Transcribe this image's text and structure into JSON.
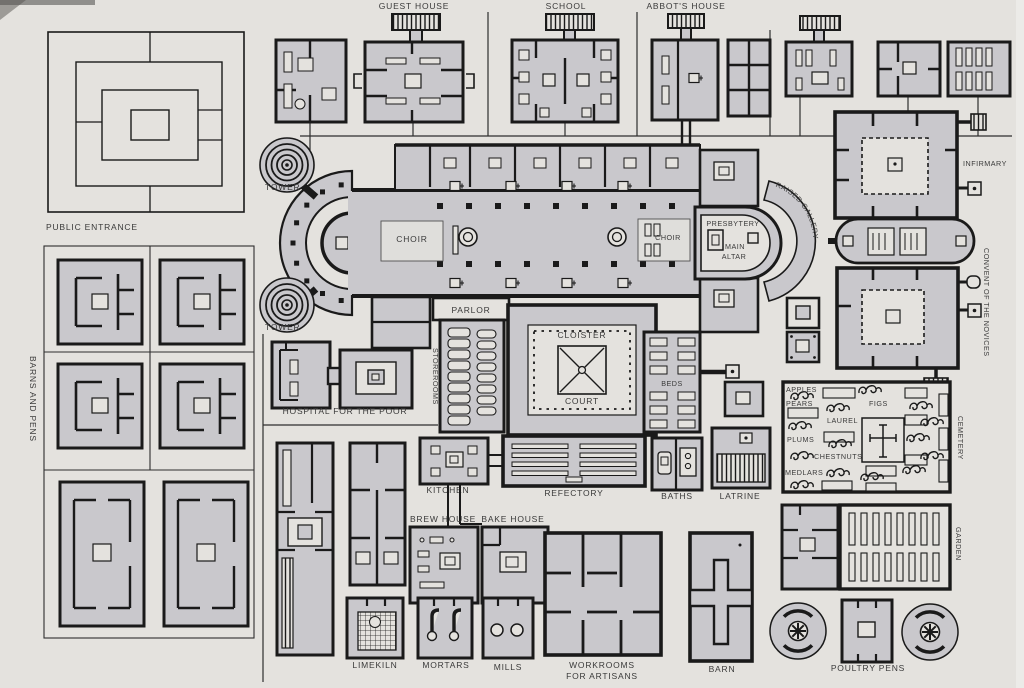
{
  "figure": {
    "type": "monastery-plan-diagram"
  },
  "palette": {
    "paper": "#e4e2de",
    "building": "#c9c8cc",
    "wall": "#1a1a1a",
    "label": "#3a3a3a"
  },
  "labels": {
    "guest_house": "GUEST HOUSE",
    "school": "SCHOOL",
    "abbots_house": "ABBOT'S HOUSE",
    "public_entrance": "PUBLIC ENTRANCE",
    "tower_north": "TOWER",
    "tower_south": "TOWER",
    "choir_west": "CHOIR",
    "choir_east": "CHOIR",
    "presbytery": "PRESBYTERY",
    "main_altar_line1": "MAIN",
    "main_altar_line2": "ALTAR",
    "raised_gallery": "RAISED GALLERY",
    "infirmary": "INFIRMARY",
    "convent_of_the_novices": "CONVENT OF THE NOVICES",
    "barns_and_pens": "BARNS AND PENS",
    "parlor": "PARLOR",
    "cloister": "CLOISTER",
    "court": "COURT",
    "storerooms": "STOREROOMS",
    "hospital_for_the_poor": "HOSPITAL FOR THE POOR",
    "beds": "BEDS",
    "apples": "APPLES",
    "pears": "PEARS",
    "figs": "FIGS",
    "laurel": "LAUREL",
    "plums": "PLUMS",
    "chestnuts": "CHESTNUTS",
    "medlars": "MEDLARS",
    "cemetery": "CEMETERY",
    "kitchen": "KITCHEN",
    "refectory": "REFECTORY",
    "baths": "BATHS",
    "latrine": "LATRINE",
    "brew_house": "BREW HOUSE",
    "bake_house": "BAKE HOUSE",
    "garden": "GARDEN",
    "limekiln": "LIMEKILN",
    "mortars": "MORTARS",
    "mills": "MILLS",
    "workrooms_line1": "WORKROOMS",
    "workrooms_line2": "FOR ARTISANS",
    "barn": "BARN",
    "poultry_pens": "POULTRY PENS"
  }
}
